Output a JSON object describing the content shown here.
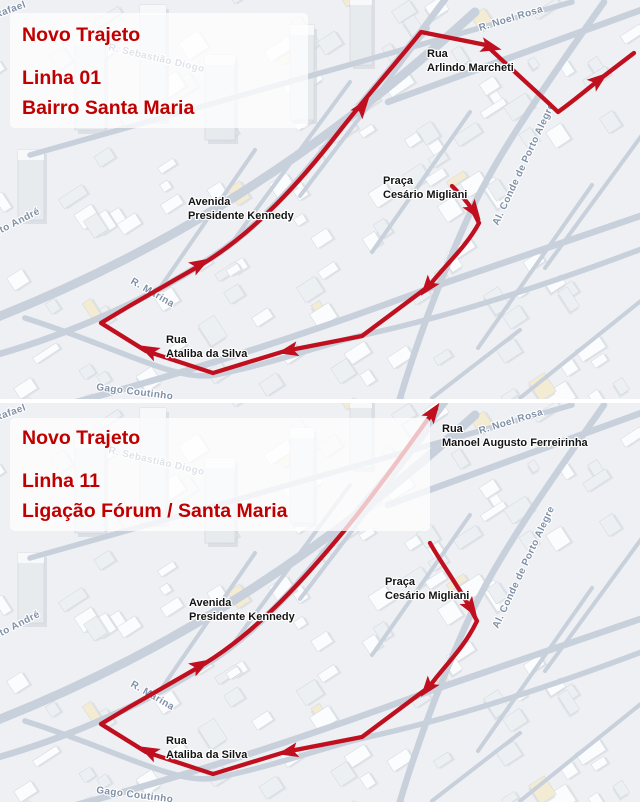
{
  "colors": {
    "route_red": "#c00f1e",
    "title_red": "#c00000",
    "poi_text": "#141414",
    "street_text": "#8090a8",
    "road": "#c7d0db",
    "map_bg": "#eef0f3"
  },
  "panels": [
    {
      "id": "linha-01",
      "title": {
        "line1": "Novo Trajeto",
        "line2": "Linha 01",
        "line3": "Bairro Santa Maria",
        "box": {
          "x": 10,
          "y": 13,
          "w": 298,
          "h": 115
        }
      },
      "street_labels": [
        {
          "text": "Rafael",
          "x": -4,
          "y": 18,
          "rot": -20
        },
        {
          "text": "R. Sebastião Diogo",
          "x": 108,
          "y": 50,
          "rot": 13
        },
        {
          "text": "R. Noel Rosa",
          "x": 480,
          "y": 31,
          "rot": -17
        },
        {
          "text": "Al. Conde de Porto Alegre",
          "x": 498,
          "y": 226,
          "rot": -65
        },
        {
          "text": "R. Marina",
          "x": 130,
          "y": 283,
          "rot": 30
        },
        {
          "text": "Gago Coutinho",
          "x": 96,
          "y": 390,
          "rot": 7
        },
        {
          "text": "Santo André",
          "x": -16,
          "y": 242,
          "rot": -27
        }
      ],
      "poi_labels": [
        {
          "lines": [
            "Rua",
            "Arlindo Marcheti"
          ],
          "x": 427,
          "y": 57
        },
        {
          "lines": [
            "Praça",
            "Cesário Migliani"
          ],
          "x": 383,
          "y": 184
        },
        {
          "lines": [
            "Avenida",
            "Presidente Kennedy"
          ],
          "x": 188,
          "y": 205
        },
        {
          "lines": [
            "Rua",
            "Ataliba da Silva"
          ],
          "x": 166,
          "y": 343
        }
      ],
      "route": {
        "path": "M 452,186 C 460,194 467,201 473,211 L 479,223 C 466,247 447,263 429,286 L 362,336 L 285,351 L 213,373 L 146,351 L 101,323 C 140,299 172,282 204,263 C 256,231 301,181 338,133 C 366,97 392,68 421,32 C 441,36 462,40 486,45 C 509,67 536,91 558,112 C 572,102 584,92 600,79 L 634,53",
        "width": 4.3,
        "arrows": [
          {
            "x": 472,
            "y": 208,
            "rot": 55
          },
          {
            "x": 430,
            "y": 284,
            "rot": 128
          },
          {
            "x": 292,
            "y": 350,
            "rot": 168
          },
          {
            "x": 152,
            "y": 352,
            "rot": 207
          },
          {
            "x": 197,
            "y": 266,
            "rot": -30
          },
          {
            "x": 360,
            "y": 110,
            "rot": -53
          },
          {
            "x": 487,
            "y": 46,
            "rot": 14
          },
          {
            "x": 596,
            "y": 82,
            "rot": -38
          }
        ]
      }
    },
    {
      "id": "linha-11",
      "title": {
        "line1": "Novo Trajeto",
        "line2": "Linha 11",
        "line3": "Ligação Fórum / Santa Maria",
        "box": {
          "x": 10,
          "y": 15,
          "w": 420,
          "h": 113
        }
      },
      "street_labels": [
        {
          "text": "Rafael",
          "x": -4,
          "y": 18,
          "rot": -20
        },
        {
          "text": "R. Sebastião Diogo",
          "x": 108,
          "y": 50,
          "rot": 13
        },
        {
          "text": "R. Noel Rosa",
          "x": 480,
          "y": 31,
          "rot": -17
        },
        {
          "text": "Al. Conde de Porto Alegre",
          "x": 498,
          "y": 226,
          "rot": -65
        },
        {
          "text": "R. Marina",
          "x": 130,
          "y": 283,
          "rot": 30
        },
        {
          "text": "Gago Coutinho",
          "x": 96,
          "y": 390,
          "rot": 7
        },
        {
          "text": "Santo André",
          "x": -16,
          "y": 242,
          "rot": -27
        }
      ],
      "poi_labels": [
        {
          "lines": [
            "Rua",
            "Manoel Augusto Ferreirinha"
          ],
          "x": 442,
          "y": 29
        },
        {
          "lines": [
            "Praça",
            "Cesário Migliani"
          ],
          "x": 385,
          "y": 182
        },
        {
          "lines": [
            "Avenida",
            "Presidente Kennedy"
          ],
          "x": 189,
          "y": 203
        },
        {
          "lines": [
            "Rua",
            "Ataliba da Silva"
          ],
          "x": 166,
          "y": 341
        }
      ],
      "route": {
        "path": "M 430,140 C 440,158 456,180 469,203 L 477,218 C 464,245 446,261 429,284 L 362,334 L 285,349 L 213,371 L 146,349 L 101,321 C 140,297 172,280 204,261 C 258,228 305,175 344,128 C 372,94 402,52 425,20 L 436,6",
        "width": 4.3,
        "arrows": [
          {
            "x": 469,
            "y": 202,
            "rot": 57
          },
          {
            "x": 430,
            "y": 282,
            "rot": 128
          },
          {
            "x": 292,
            "y": 348,
            "rot": 168
          },
          {
            "x": 152,
            "y": 350,
            "rot": 207
          },
          {
            "x": 197,
            "y": 264,
            "rot": -30
          },
          {
            "x": 431,
            "y": 12,
            "rot": -55
          }
        ]
      }
    }
  ]
}
